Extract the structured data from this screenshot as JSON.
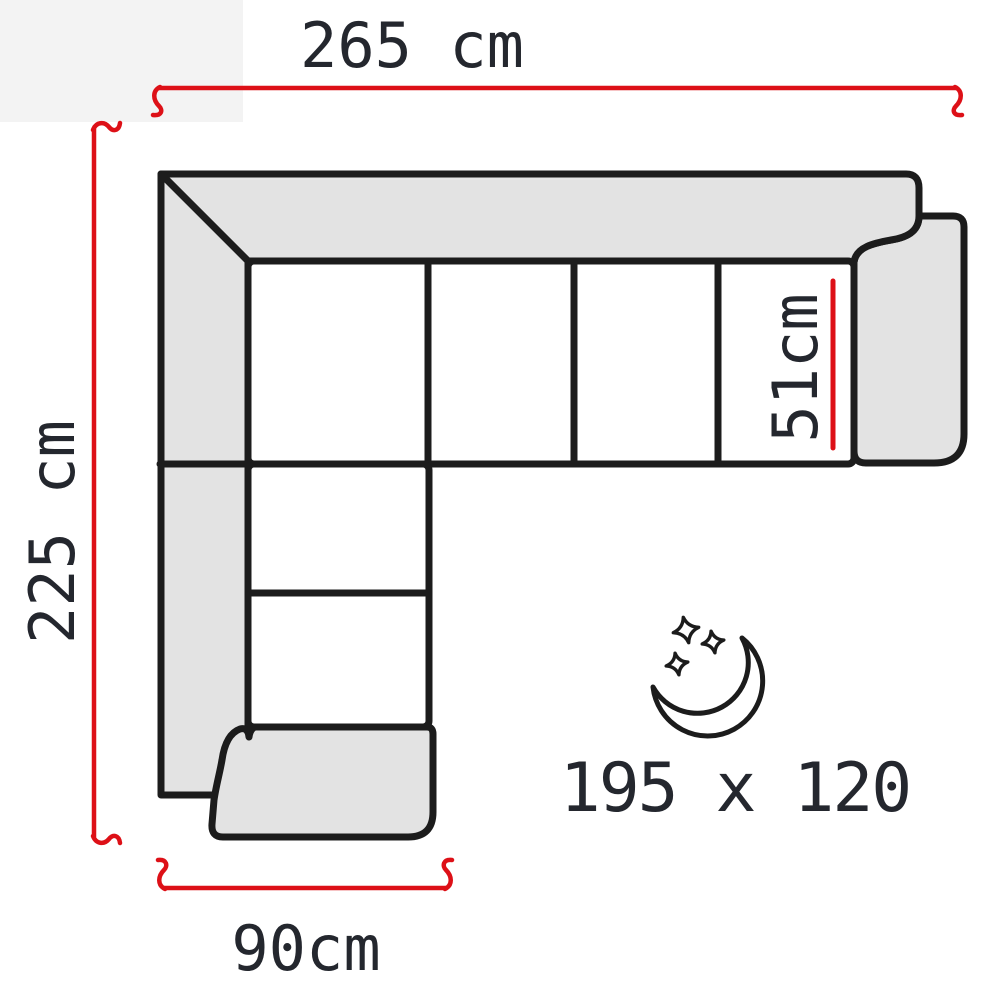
{
  "colors": {
    "background": "#ffffff",
    "corner_patch": "#f3f3f3",
    "outline": "#1c1c1c",
    "upholstery_fill": "#e3e3e3",
    "seat_fill": "#ffffff",
    "dimension_line": "#dd1017",
    "label_text": "#24272e"
  },
  "diagram": {
    "labels": {
      "overall_width": "265 cm",
      "overall_depth": "225 cm",
      "seat_width": "51cm",
      "chaise_width": "90cm",
      "sleeping_area": "195 x 120"
    },
    "icons": [
      {
        "name": "moon-with-stars-icon"
      }
    ]
  }
}
